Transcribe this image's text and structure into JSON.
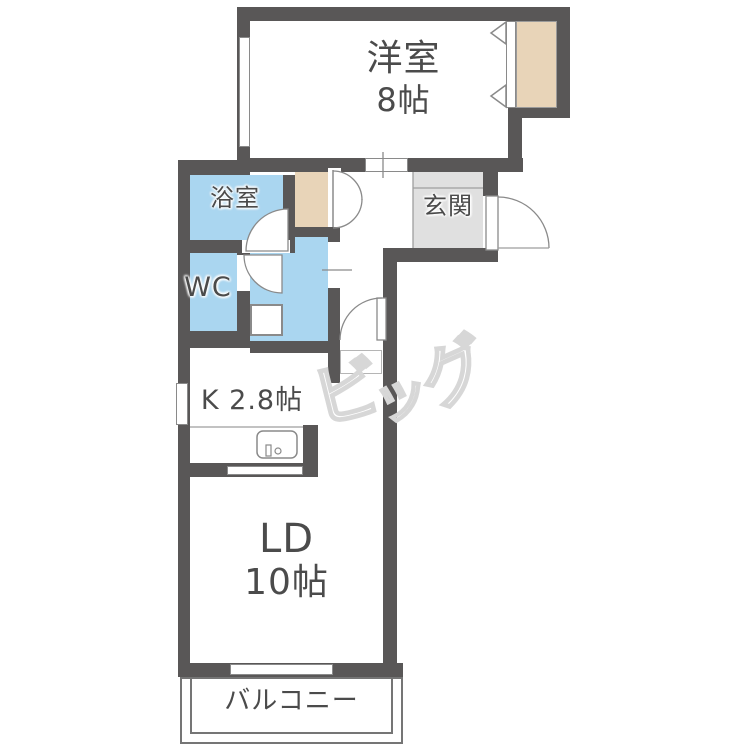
{
  "document_type": "floor-plan",
  "rooms": {
    "western_room": {
      "name": "洋室",
      "size": "8帖"
    },
    "bath": {
      "name": "浴室"
    },
    "toilet": {
      "name": "WC"
    },
    "entrance": {
      "name": "玄関"
    },
    "kitchen": {
      "name": "K 2.8帖"
    },
    "living_dining": {
      "name": "LD",
      "size": "10帖"
    },
    "balcony": {
      "name": "バルコニー"
    }
  },
  "watermark": {
    "text": "ビッグ",
    "chars": [
      "ビ",
      "ッ",
      "グ"
    ]
  },
  "colors": {
    "wall": "#595757",
    "wet_room_fill": "#aad6f0",
    "closet_fill": "#e8d4b8",
    "entrance_fill": "#e0e0e0",
    "label_text": "#4b4b4b",
    "watermark_outline": "#d7d7d7"
  }
}
